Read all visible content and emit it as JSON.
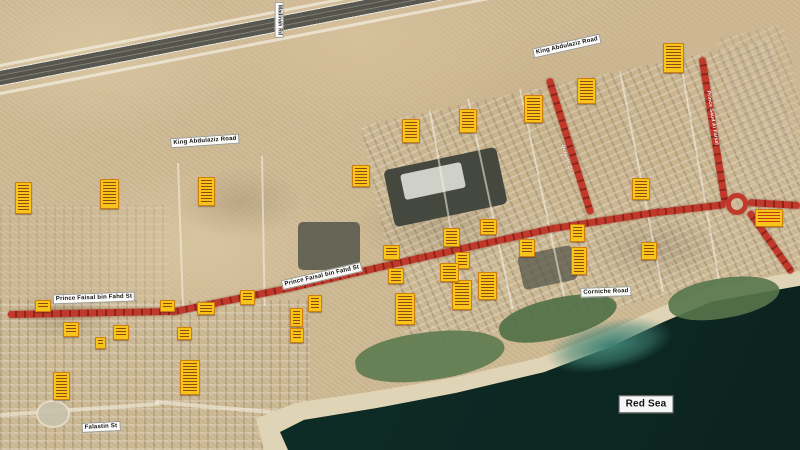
{
  "map": {
    "description": "Satellite map with highlighted road corridor and annotation markers",
    "colors": {
      "route_red": "#c0392b",
      "route_red_dark": "#8e241a",
      "marker_yellow": "#f6c51b",
      "marker_border": "#cf7d0f",
      "sea_dark": "#0e2a25",
      "sand": "#cfba94"
    },
    "road_labels": [
      {
        "text": "King Abdulaziz Road",
        "x": 205,
        "y": 141,
        "rot": -4,
        "size": 6,
        "style": "plain"
      },
      {
        "text": "King Abdulaziz Road",
        "x": 567,
        "y": 46,
        "rot": -12.5,
        "size": 6,
        "style": "plain"
      },
      {
        "text": "Prince Faisal bin Fahd St",
        "x": 94,
        "y": 298,
        "rot": -2,
        "size": 6,
        "style": "plain"
      },
      {
        "text": "Prince Faisal bin Fahd St",
        "x": 322,
        "y": 276,
        "rot": -13,
        "size": 6,
        "style": "plain"
      },
      {
        "text": "Corniche Road",
        "x": 606,
        "y": 292,
        "rot": -2,
        "size": 6,
        "style": "plain"
      },
      {
        "text": "Falastin St",
        "x": 101,
        "y": 427,
        "rot": -3,
        "size": 6,
        "style": "plain"
      },
      {
        "text": "Red Sea",
        "x": 646,
        "y": 404,
        "rot": 0,
        "size": 10,
        "style": "sea"
      },
      {
        "text": "Madinah Rd",
        "x": 279,
        "y": 20,
        "rot": 0,
        "size": 5,
        "style": "vertical"
      },
      {
        "text": "Prince Saud Al Faisal",
        "x": 712,
        "y": 118,
        "rot": 81,
        "size": 5,
        "style": "on-route"
      },
      {
        "text": "Quraish St",
        "x": 566,
        "y": 158,
        "rot": 73,
        "size": 5,
        "style": "on-route"
      }
    ],
    "route": {
      "color": "#c0392b",
      "segments": [
        {
          "x1": 8,
          "y1": 314,
          "x2": 172,
          "y2": 311
        },
        {
          "x1": 170,
          "y1": 312,
          "x2": 292,
          "y2": 287
        },
        {
          "x1": 288,
          "y1": 288,
          "x2": 422,
          "y2": 257
        },
        {
          "x1": 418,
          "y1": 258,
          "x2": 557,
          "y2": 227
        },
        {
          "x1": 553,
          "y1": 228,
          "x2": 662,
          "y2": 211
        },
        {
          "x1": 658,
          "y1": 212,
          "x2": 726,
          "y2": 204
        },
        {
          "x1": 748,
          "y1": 202,
          "x2": 800,
          "y2": 205
        },
        {
          "x1": 749,
          "y1": 211,
          "x2": 792,
          "y2": 272
        },
        {
          "x1": 702,
          "y1": 57,
          "x2": 725,
          "y2": 202
        },
        {
          "x1": 549,
          "y1": 78,
          "x2": 591,
          "y2": 214
        }
      ],
      "roundabout": {
        "x": 737,
        "y": 204,
        "r": 11
      }
    },
    "markers": [
      {
        "x": 672,
        "y": 57,
        "w": 19,
        "h": 28,
        "variant": "orange"
      },
      {
        "x": 585,
        "y": 90,
        "w": 17,
        "h": 24,
        "variant": "orange"
      },
      {
        "x": 532,
        "y": 108,
        "w": 17,
        "h": 26,
        "variant": "orange"
      },
      {
        "x": 467,
        "y": 120,
        "w": 16,
        "h": 22,
        "variant": "orange"
      },
      {
        "x": 410,
        "y": 130,
        "w": 16,
        "h": 22,
        "variant": "orange"
      },
      {
        "x": 360,
        "y": 175,
        "w": 16,
        "h": 20,
        "variant": "orange"
      },
      {
        "x": 22,
        "y": 197,
        "w": 15,
        "h": 30,
        "variant": "orange"
      },
      {
        "x": 108,
        "y": 193,
        "w": 17,
        "h": 28,
        "variant": "orange"
      },
      {
        "x": 205,
        "y": 190,
        "w": 15,
        "h": 27,
        "variant": "orange"
      },
      {
        "x": 640,
        "y": 188,
        "w": 16,
        "h": 20,
        "variant": "orange"
      },
      {
        "x": 768,
        "y": 217,
        "w": 26,
        "h": 16,
        "variant": "red-text"
      },
      {
        "x": 648,
        "y": 250,
        "w": 14,
        "h": 16,
        "variant": "orange"
      },
      {
        "x": 576,
        "y": 232,
        "w": 13,
        "h": 16,
        "variant": "orange"
      },
      {
        "x": 578,
        "y": 260,
        "w": 14,
        "h": 26,
        "variant": "orange"
      },
      {
        "x": 526,
        "y": 247,
        "w": 14,
        "h": 16,
        "variant": "orange"
      },
      {
        "x": 487,
        "y": 226,
        "w": 15,
        "h": 14,
        "variant": "orange"
      },
      {
        "x": 486,
        "y": 285,
        "w": 17,
        "h": 26,
        "variant": "orange"
      },
      {
        "x": 461,
        "y": 294,
        "w": 18,
        "h": 28,
        "variant": "orange"
      },
      {
        "x": 461,
        "y": 259,
        "w": 13,
        "h": 15,
        "variant": "orange"
      },
      {
        "x": 450,
        "y": 236,
        "w": 15,
        "h": 17,
        "variant": "orange"
      },
      {
        "x": 448,
        "y": 271,
        "w": 17,
        "h": 17,
        "variant": "orange"
      },
      {
        "x": 390,
        "y": 251,
        "w": 15,
        "h": 13,
        "variant": "orange"
      },
      {
        "x": 395,
        "y": 275,
        "w": 14,
        "h": 14,
        "variant": "orange"
      },
      {
        "x": 404,
        "y": 308,
        "w": 18,
        "h": 30,
        "variant": "orange"
      },
      {
        "x": 314,
        "y": 302,
        "w": 12,
        "h": 15,
        "variant": "orange"
      },
      {
        "x": 295,
        "y": 316,
        "w": 11,
        "h": 17,
        "variant": "orange"
      },
      {
        "x": 296,
        "y": 334,
        "w": 12,
        "h": 13,
        "variant": "orange"
      },
      {
        "x": 246,
        "y": 296,
        "w": 13,
        "h": 13,
        "variant": "orange"
      },
      {
        "x": 205,
        "y": 307,
        "w": 16,
        "h": 11,
        "variant": "orange"
      },
      {
        "x": 166,
        "y": 305,
        "w": 13,
        "h": 10,
        "variant": "orange"
      },
      {
        "x": 42,
        "y": 305,
        "w": 14,
        "h": 10,
        "variant": "orange"
      },
      {
        "x": 70,
        "y": 328,
        "w": 14,
        "h": 13,
        "variant": "orange"
      },
      {
        "x": 99,
        "y": 342,
        "w": 9,
        "h": 10,
        "variant": "orange"
      },
      {
        "x": 120,
        "y": 331,
        "w": 14,
        "h": 13,
        "variant": "orange"
      },
      {
        "x": 183,
        "y": 332,
        "w": 13,
        "h": 11,
        "variant": "orange"
      },
      {
        "x": 60,
        "y": 385,
        "w": 15,
        "h": 26,
        "variant": "orange"
      },
      {
        "x": 189,
        "y": 376,
        "w": 18,
        "h": 33,
        "variant": "orange"
      }
    ]
  }
}
